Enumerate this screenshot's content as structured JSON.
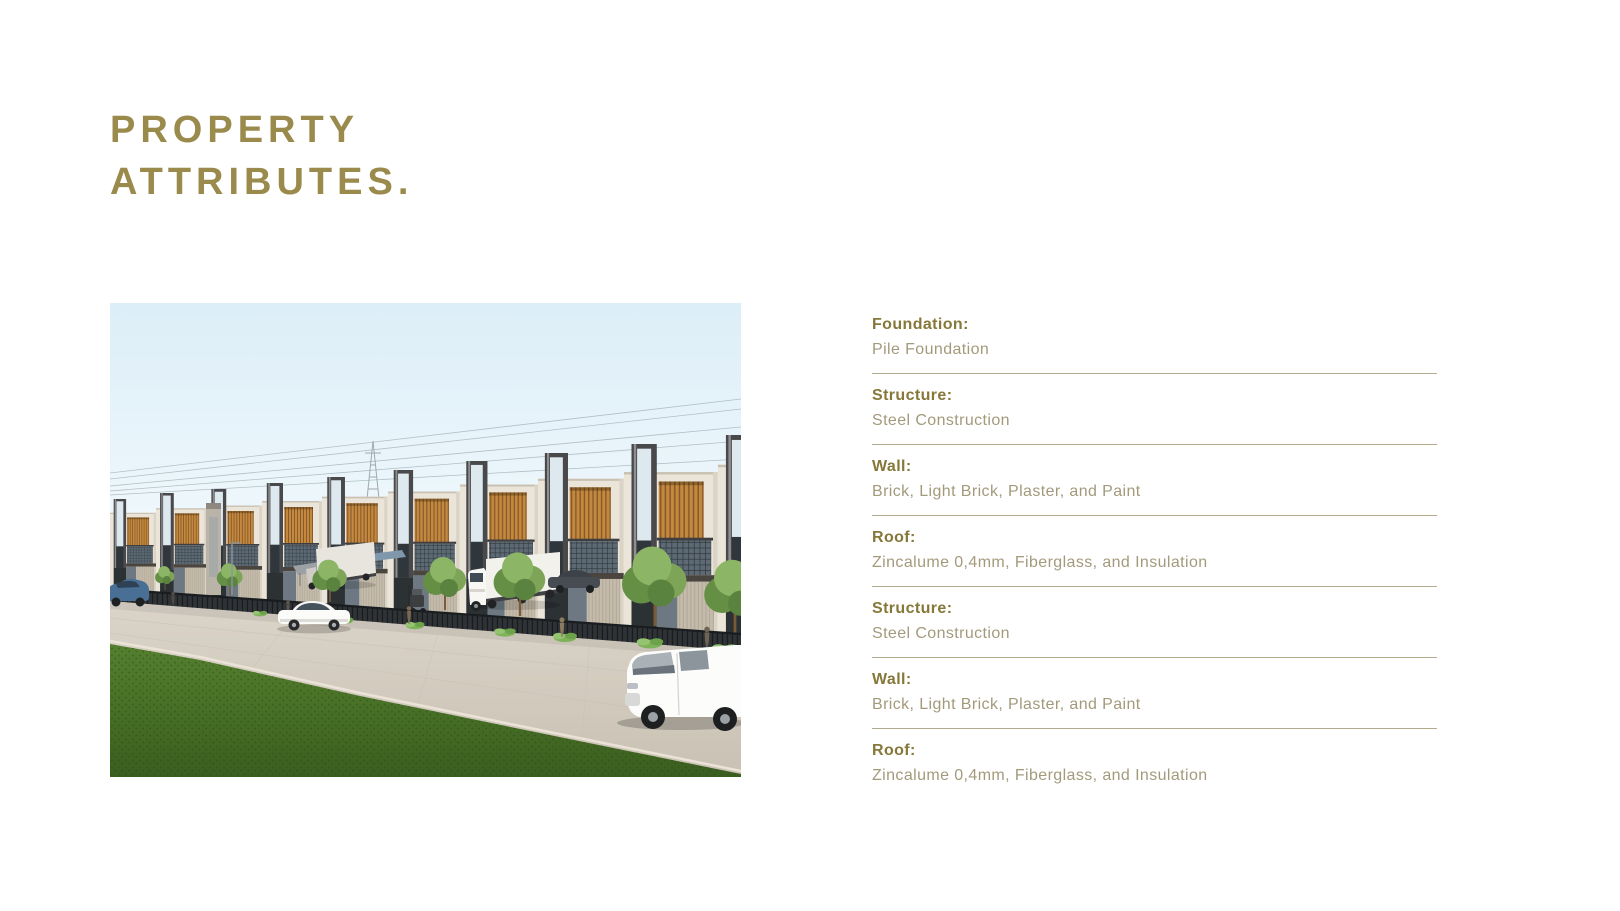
{
  "title": {
    "line1": "PROPERTY",
    "line2": "ATTRIBUTES."
  },
  "colors": {
    "title_olive": "#9a8b4d",
    "label_olive": "#857839",
    "value_olive": "#a39a7c",
    "divider": "#b3ab8e",
    "background": "#ffffff"
  },
  "attributes": {
    "items": [
      {
        "label": "Foundation:",
        "value": "Pile Foundation"
      },
      {
        "label": "Structure:",
        "value": "Steel Construction"
      },
      {
        "label": "Wall:",
        "value": "Brick, Light Brick, Plaster, and Paint"
      },
      {
        "label": "Roof:",
        "value": "Zincalume 0,4mm, Fiberglass, and Insulation"
      },
      {
        "label": "Structure:",
        "value": "Steel Construction"
      },
      {
        "label": "Wall:",
        "value": "Brick, Light Brick, Plaster, and Paint"
      },
      {
        "label": "Roof:",
        "value": "Zincalume 0,4mm, Fiberglass, and Insulation"
      }
    ]
  },
  "render": {
    "unit_labels": [
      "5F",
      "G"
    ]
  }
}
